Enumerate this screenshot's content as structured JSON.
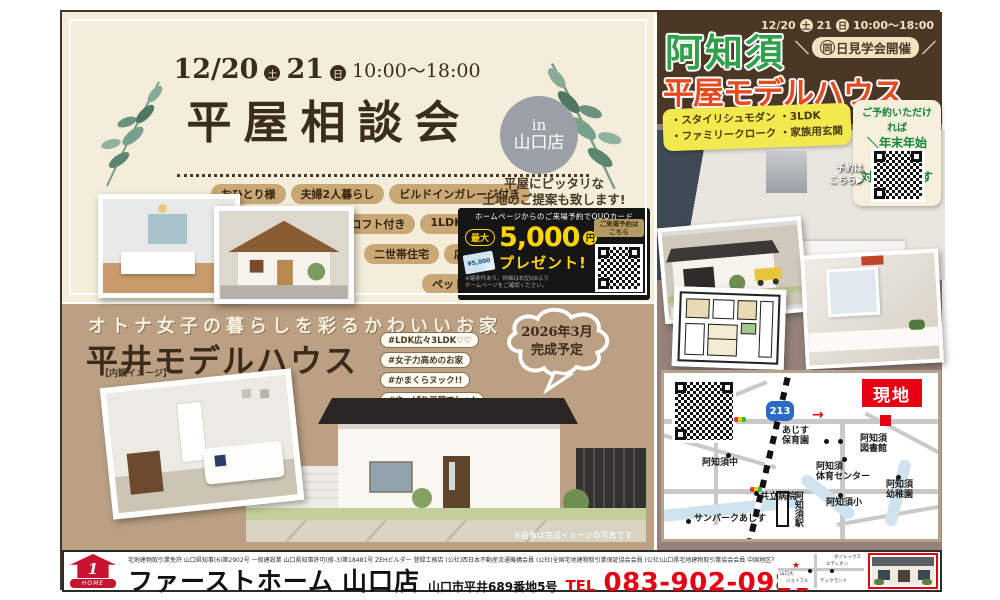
{
  "left": {
    "date1": "12/20",
    "sat": "土",
    "date2": "21",
    "sun": "日",
    "time": "10:00～18:00",
    "title": "平屋相談会",
    "badge_in": "in",
    "badge_store": "山口店",
    "tags": [
      "おひとり様",
      "夫婦2人暮らし",
      "ビルドインガレージ付き",
      "コの字型",
      "ロフト付き",
      "1LDK",
      "5LDK",
      "二世帯住宅",
      "店舗併用住宅",
      "ペットと住むお家",
      "借家・アパート計画"
    ],
    "land_note1": "平屋にピッタリな",
    "land_note2": "土地のご提案も致します!",
    "quo": {
      "header": "ホームページからのご来場予約でQUOカード",
      "max": "最大",
      "amount": "5,000",
      "yen": "円",
      "card_amount": "¥5,000",
      "present": "プレゼント!",
      "reserve1": "ご来場予約は",
      "reserve2": "こちら",
      "note1": "※諸条件あり。詳細は右記QRより",
      "note2": "ホームページをご確認ください。"
    }
  },
  "middle": {
    "catch": "オトナ女子の暮らしを彩るかわいいお家",
    "title": "平井モデルハウス",
    "hashtags": [
      "#LDK広々3LDK♡♡",
      "#女子力高めのお家",
      "#かまくらヌック!!",
      "#やっぱり平屋でしょ!"
    ],
    "bubble1": "2026年3月",
    "bubble2": "完成予定",
    "interior_label": "【内観イメージ】",
    "render_note": "※画像は完成イメージの写真です"
  },
  "right": {
    "date1": "12/20",
    "sat": "土",
    "date2": "21",
    "sun": "日",
    "time": "10:00～18:00",
    "badge_l": "＼",
    "badge_first": "同",
    "badge_rest": "日見学会開催",
    "badge_r": "／",
    "area": "阿知須",
    "title": "平屋モデルハウス",
    "f1": "・スタイリシュモダン ・3LDK",
    "f2": "・ファミリークローク ・家族用玄関",
    "promo_l": "＼",
    "promo1": "ご予約いただければ",
    "promo2": "年末年始も",
    "promo3": "対応致します",
    "promo_r": "／",
    "reserve1": "予約は",
    "reserve2": "こちら▶",
    "image_note": "※画像はイメージです",
    "map": {
      "genchi": "現地",
      "route": "213",
      "hoikuen1": "あじす",
      "hoikuen2": "保育園",
      "tosyokan1": "阿知須",
      "tosyokan2": "図書館",
      "chu": "阿知須中",
      "taiiku1": "阿知須",
      "taiiku2": "体育センター",
      "byoin": "共立病院",
      "yochien1": "阿知須",
      "yochien2": "幼稚園",
      "sho": "阿知須小",
      "sunpark": "サンパークあじす",
      "eki": "阿知須駅"
    }
  },
  "footer": {
    "license": "宅地建物取引業免許 山口県知事(6)第2902号 一般建設業 山口県知事許可(般-3)第18481号 ZEHビルダー 登録工務店 (公社)西日本不動産流通機構会員 (公社)全国宅地建物取引業保証協会会員 (公社)山口県宅地建物取引業協会会員 中国地区不動産公正取引協議会加盟",
    "logo_one": "1",
    "logo_home": "HOME",
    "company": "ファーストホーム",
    "store": "山口店",
    "address": "山口市平井689番地5号",
    "tel_label": "TEL",
    "tel": "083-902-0980",
    "minimap": {
      "l1": "ダイレックス",
      "l2": "エディオン",
      "l3": "ジョイフル",
      "l4": "テックランド",
      "l5": "山口大"
    }
  }
}
